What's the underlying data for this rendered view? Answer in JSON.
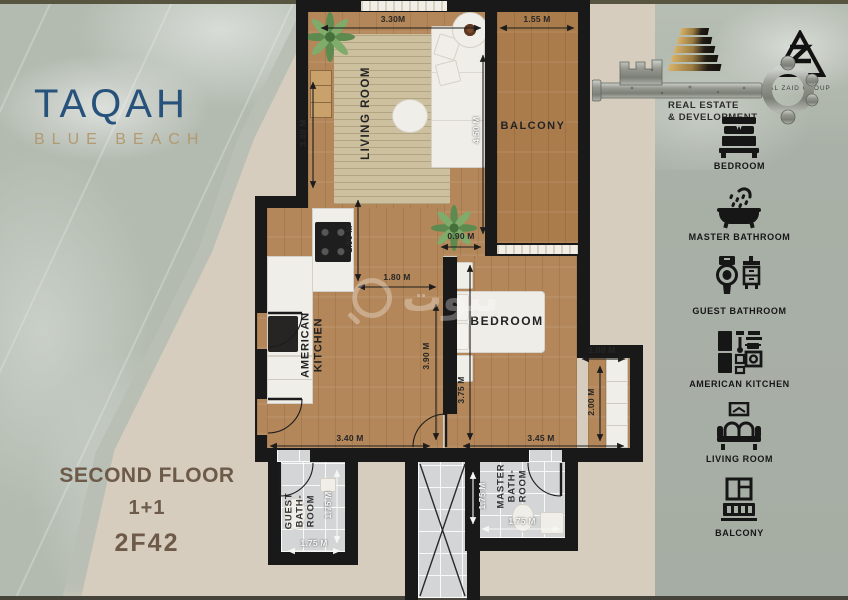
{
  "brand": {
    "title": "TAQAH",
    "subtitle": "BLUE BEACH"
  },
  "unit": {
    "floor": "SECOND FLOOR",
    "layout": "1+1",
    "code": "2F42"
  },
  "developer": {
    "name": "AL ZAID",
    "line1": "REAL ESTATE",
    "line2": "& DEVELOPMENT",
    "group": "AL ZAID GROUP"
  },
  "watermark": {
    "text": "بيوت"
  },
  "floorplan": {
    "labels": {
      "living_room": "LIVING ROOM",
      "balcony": "BALCONY",
      "kitchen": [
        "AMERICAN",
        "KITCHEN"
      ],
      "bedroom": "BEDROOM",
      "guest_bath": [
        "GUEST",
        "BATH-",
        "ROOM"
      ],
      "master_bath": [
        "MASTER",
        "BATH-",
        "ROOM"
      ]
    },
    "dims": {
      "living_width": "3.30M",
      "balcony_width": "1.55 M",
      "living_height_left": "3.40 M",
      "living_height_right": "4.50 M",
      "kitchen_depth": "1.90 M",
      "hall_width": "1.80 M",
      "passage_width": "0.90 M",
      "hall_height": "3.90 M",
      "bedroom_height": "3.75 M",
      "nook_width": "1.00 M",
      "nook_height": "2.00 M",
      "hall_bottom_width": "3.40 M",
      "bedroom_width": "3.45 M",
      "guest_bath_height": "1.75 M",
      "guest_bath_width": "1.75 M",
      "master_bath_height": "1.75 M",
      "master_bath_width": "1.75 M"
    }
  },
  "legend": {
    "items": [
      {
        "icon": "bed-icon",
        "label": "BEDROOM"
      },
      {
        "icon": "bathtub-icon",
        "label": "MASTER BATHROOM"
      },
      {
        "icon": "toilet-icon",
        "label": "GUEST BATHROOM"
      },
      {
        "icon": "kitchen-icon",
        "label": "AMERICAN KITCHEN"
      },
      {
        "icon": "sofa-icon",
        "label": "LIVING ROOM"
      },
      {
        "icon": "balcony-icon",
        "label": "BALCONY"
      }
    ]
  },
  "colors": {
    "brand_blue": "#27527b",
    "brand_gold": "#b29a71",
    "floor_text_brown": "#6d5a48",
    "wall": "#191919",
    "wood": "#b4875a",
    "panel_green": "#a9b0a7",
    "page_beige": "#d6cdbf"
  }
}
